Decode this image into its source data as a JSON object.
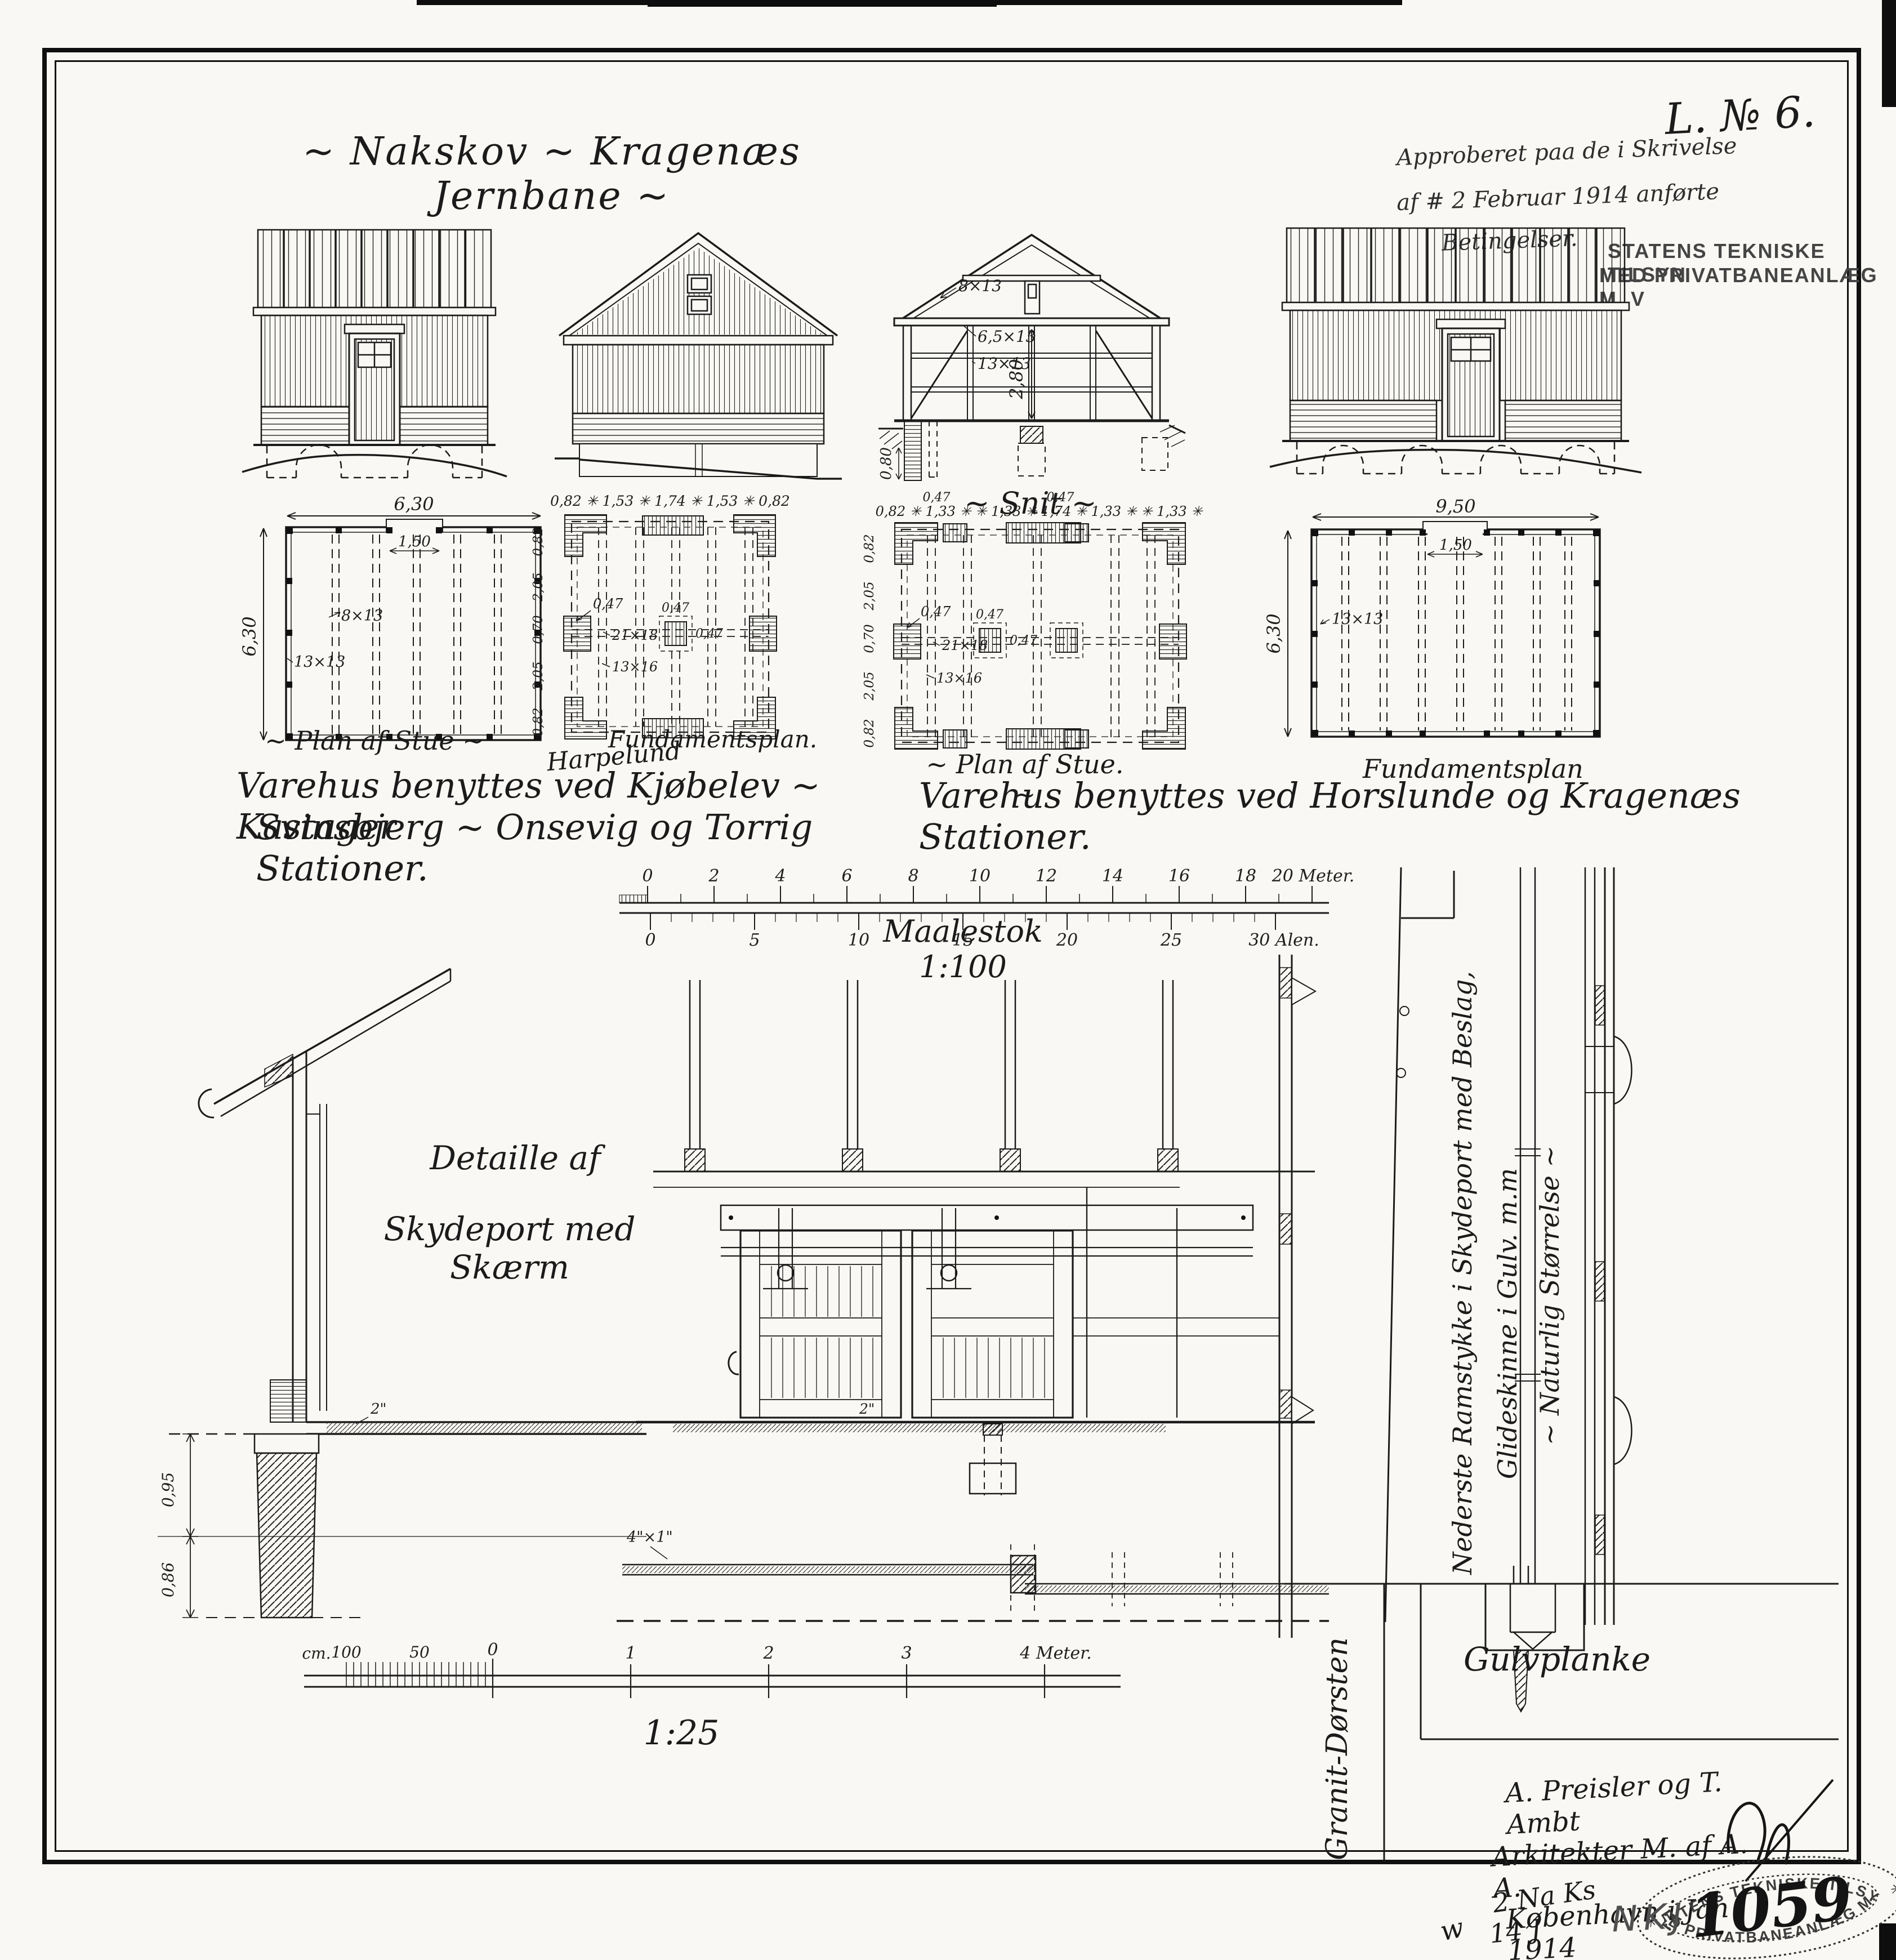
{
  "page": {
    "title": "~ Nakskov ~ Kragenæs Jernbane ~",
    "drawing_no": "L. № 6.",
    "approval_line1": "Approberet paa de i Skrivelse",
    "approval_line2": "af # 2 Februar 1914 anførte",
    "approval_line3": "Betingelser.",
    "top_stamp_line1": "STATENS TEKNISKE TILSYN",
    "top_stamp_line2": "MED PRIVATBANEANLÆG M. V"
  },
  "section": {
    "caption": "~ Snit ~",
    "label_rafter": "8×13",
    "label_beam": "6,5×13",
    "label_post": "13×13",
    "dim_height": "2,80",
    "dim_depth": "0,80"
  },
  "plans": [
    {
      "caption": "~ Plan af Stue ~",
      "dim_width": "6,30",
      "dim_height": "6,30",
      "dim_door": "1,50",
      "label_joist": "8×13",
      "label_post": "13×13"
    },
    {
      "caption": "Fundamentsplan.",
      "annotation": "Harpelund",
      "dims_top": "0,82 ✳ 1,53 ✳ 1,74 ✳ 1,53 ✳ 0,82",
      "dims_left": [
        "0,82",
        "2,05",
        "0,70",
        "2,05",
        "0,82"
      ],
      "label_pad": "0,47",
      "label_pad_center": "0,47",
      "label_pad_center2": "0,47",
      "label_beam": "21×18",
      "label_joist": "13×16"
    },
    {
      "caption": "~ Plan af Stue. ~",
      "dims_top": "0,82 ✳ 1,33 ✳ ✳ 1,33 ✳ 1,74 ✳ 1,33 ✳ ✳ 1,33 ✳",
      "dim_small_left": "0,47",
      "dim_small_right": "0,47",
      "dims_left": [
        "0,82",
        "2,05",
        "0,70",
        "2,05",
        "0,82"
      ],
      "label_pad": "0,47",
      "label_pad_center": "0,47",
      "label_pad_center2": "0,47",
      "label_beam": "21×18",
      "label_joist": "13×16"
    },
    {
      "caption": "Fundamentsplan",
      "dim_width": "9,50",
      "dim_height": "6,30",
      "dim_door": "1,50",
      "label_post": "13×13"
    }
  ],
  "usage": {
    "left1": "Varehus benyttes ved Kjøbelev ~ Kastager",
    "left2": "Svinsbjerg ~ Onsevig og Torrig Stationer.",
    "right1": "Varehus benyttes ved Horslunde og Kragenæs Stationer."
  },
  "scale100": {
    "caption": "Maalestok 1:100",
    "meter_ticks": [
      "0",
      "2",
      "4",
      "6",
      "8",
      "10",
      "12",
      "14",
      "16",
      "18"
    ],
    "meter_end": "20 Meter.",
    "alen_ticks": [
      "0",
      "5",
      "10",
      "15",
      "20",
      "25"
    ],
    "alen_end": "30 Alen."
  },
  "detail": {
    "caption1": "Detaille af",
    "caption2": "Skydeport med Skærm",
    "dim_upper": "0,95",
    "dim_lower": "0,86",
    "dim_plank": "2\"",
    "dim_plank2": "2\"",
    "dim_rail": "4\"×1\""
  },
  "scale25": {
    "caption": "1:25",
    "unit": "cm.",
    "t100": "100",
    "t50": "50",
    "t0": "0",
    "m1": "1",
    "m2": "2",
    "m3": "3",
    "m4": "4 Meter."
  },
  "fullsize": {
    "caption_line1": "Nederste Ramstykke i Skydeport med Beslag,",
    "caption_line2": "Glideskinne i Gulv. m.m",
    "caption_line3": "~ Naturlig Størrelse ~",
    "floor_plank_label": "Gulvplanke",
    "threshold_label": "Granit-Dørsten"
  },
  "signature": {
    "line1": "A. Preisler og T. Ambt",
    "line2": "Arkitekter M. af A. A.",
    "line3": "København i Jan 1914"
  },
  "bottom_stamp": {
    "arc_top": "STATENS TEKNISKE TILSYN",
    "arc_bottom": "MED PRIVATBANEANLÆG M. V.",
    "number": "1059",
    "star_left": "✳",
    "star_right": "✳"
  },
  "margin_notes": {
    "count": "2 Na Ks",
    "ref": "14 J",
    "initials": "NKJ",
    "mark": "w"
  }
}
